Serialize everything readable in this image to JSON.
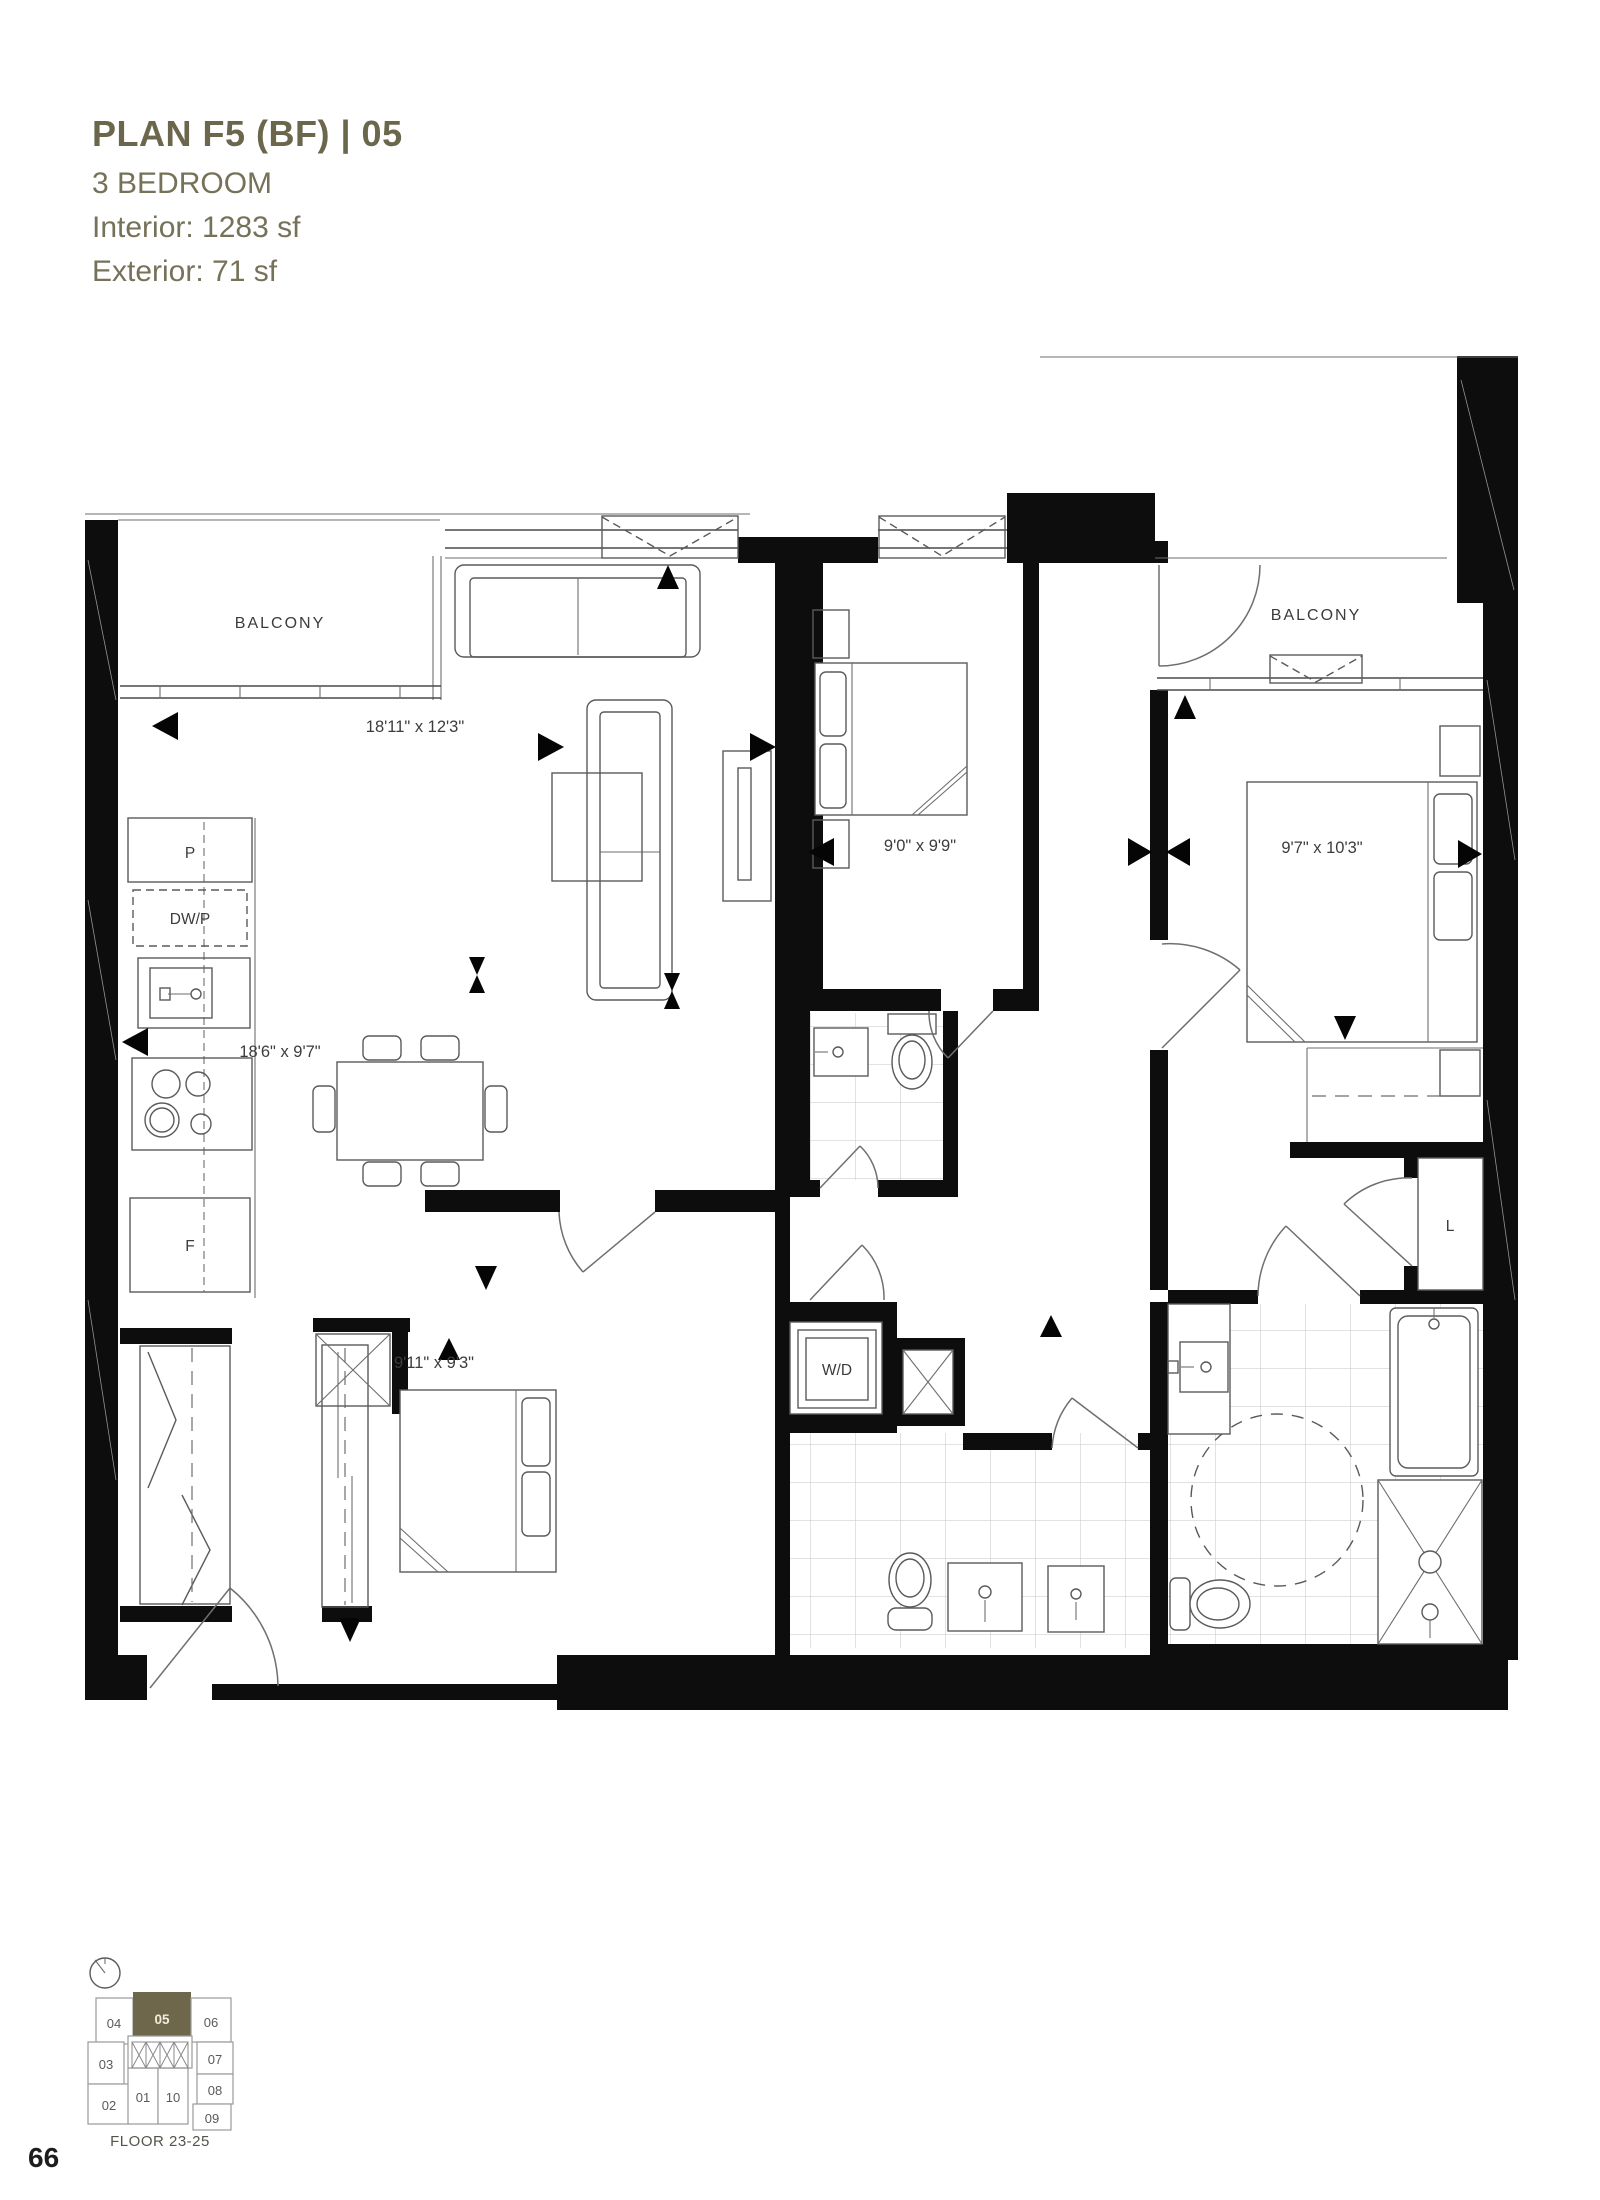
{
  "header": {
    "title": "PLAN F5 (BF) | 05",
    "subtitle": "3 BEDROOM",
    "interior": "Interior: 1283 sf",
    "exterior": "Exterior: 71 sf",
    "accent_color": "#6b674c"
  },
  "plan": {
    "rooms": {
      "balcony_left": "BALCONY",
      "balcony_right": "BALCONY"
    },
    "dims": {
      "living": "18'11\" x 12'3\"",
      "dining": "18'6\" x 9'7\"",
      "bedroom2": "9'0\" x 9'9\"",
      "master": "9'7\" x 10'3\"",
      "bedroom3": "9'11\" x 9'3\""
    },
    "labels": {
      "pantry": "P",
      "dishwasher": "DW/P",
      "fridge": "F",
      "washer_dryer": "W/D",
      "linen": "L"
    },
    "wall_color": "#0d0d0d"
  },
  "keyplan": {
    "floor": "FLOOR 23-25",
    "highlight_unit": "05",
    "highlight_color": "#6e674b",
    "highlight_text_color": "#f2edda",
    "units": [
      "04",
      "05",
      "06",
      "03",
      "07",
      "08",
      "02",
      "01",
      "10",
      "09"
    ]
  },
  "page": {
    "number": "66"
  }
}
